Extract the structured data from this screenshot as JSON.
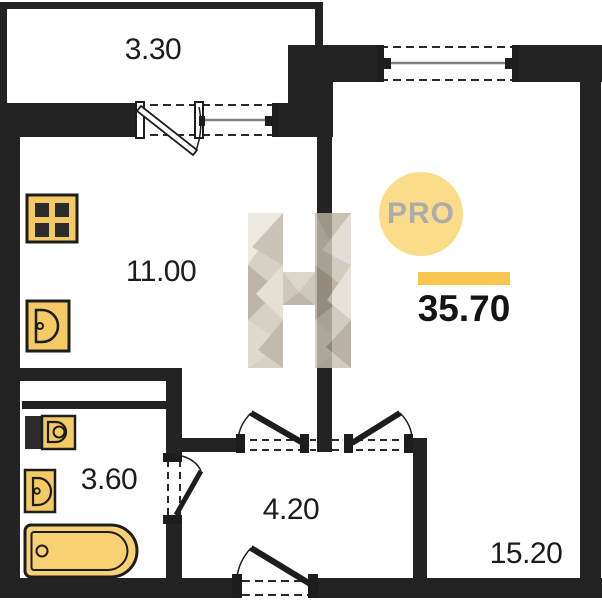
{
  "plan": {
    "type": "apartment floor plan",
    "total_area": "35.70",
    "rooms": [
      {
        "id": "balcony",
        "area": "3.30"
      },
      {
        "id": "kitchen-living-room",
        "area": "11.00"
      },
      {
        "id": "bathroom",
        "area": "3.60"
      },
      {
        "id": "hallway",
        "area": "4.20"
      },
      {
        "id": "living-room",
        "area": "15.20"
      }
    ],
    "badge": {
      "label": "PRO"
    },
    "watermark": {
      "letter": "H"
    },
    "colors": {
      "wall": "#232323",
      "fixture_fill": "#F5C963",
      "badge_circle": "#FBDC88",
      "badge_text": "#ACACAC",
      "accent_bar": "#F6C64E",
      "label_text": "#1C1C1C",
      "window_glass": "#808080"
    },
    "icons": [
      "stove-icon",
      "kitchen-sink-icon",
      "toilet-icon",
      "washbasin-icon",
      "bathtub-icon"
    ]
  }
}
